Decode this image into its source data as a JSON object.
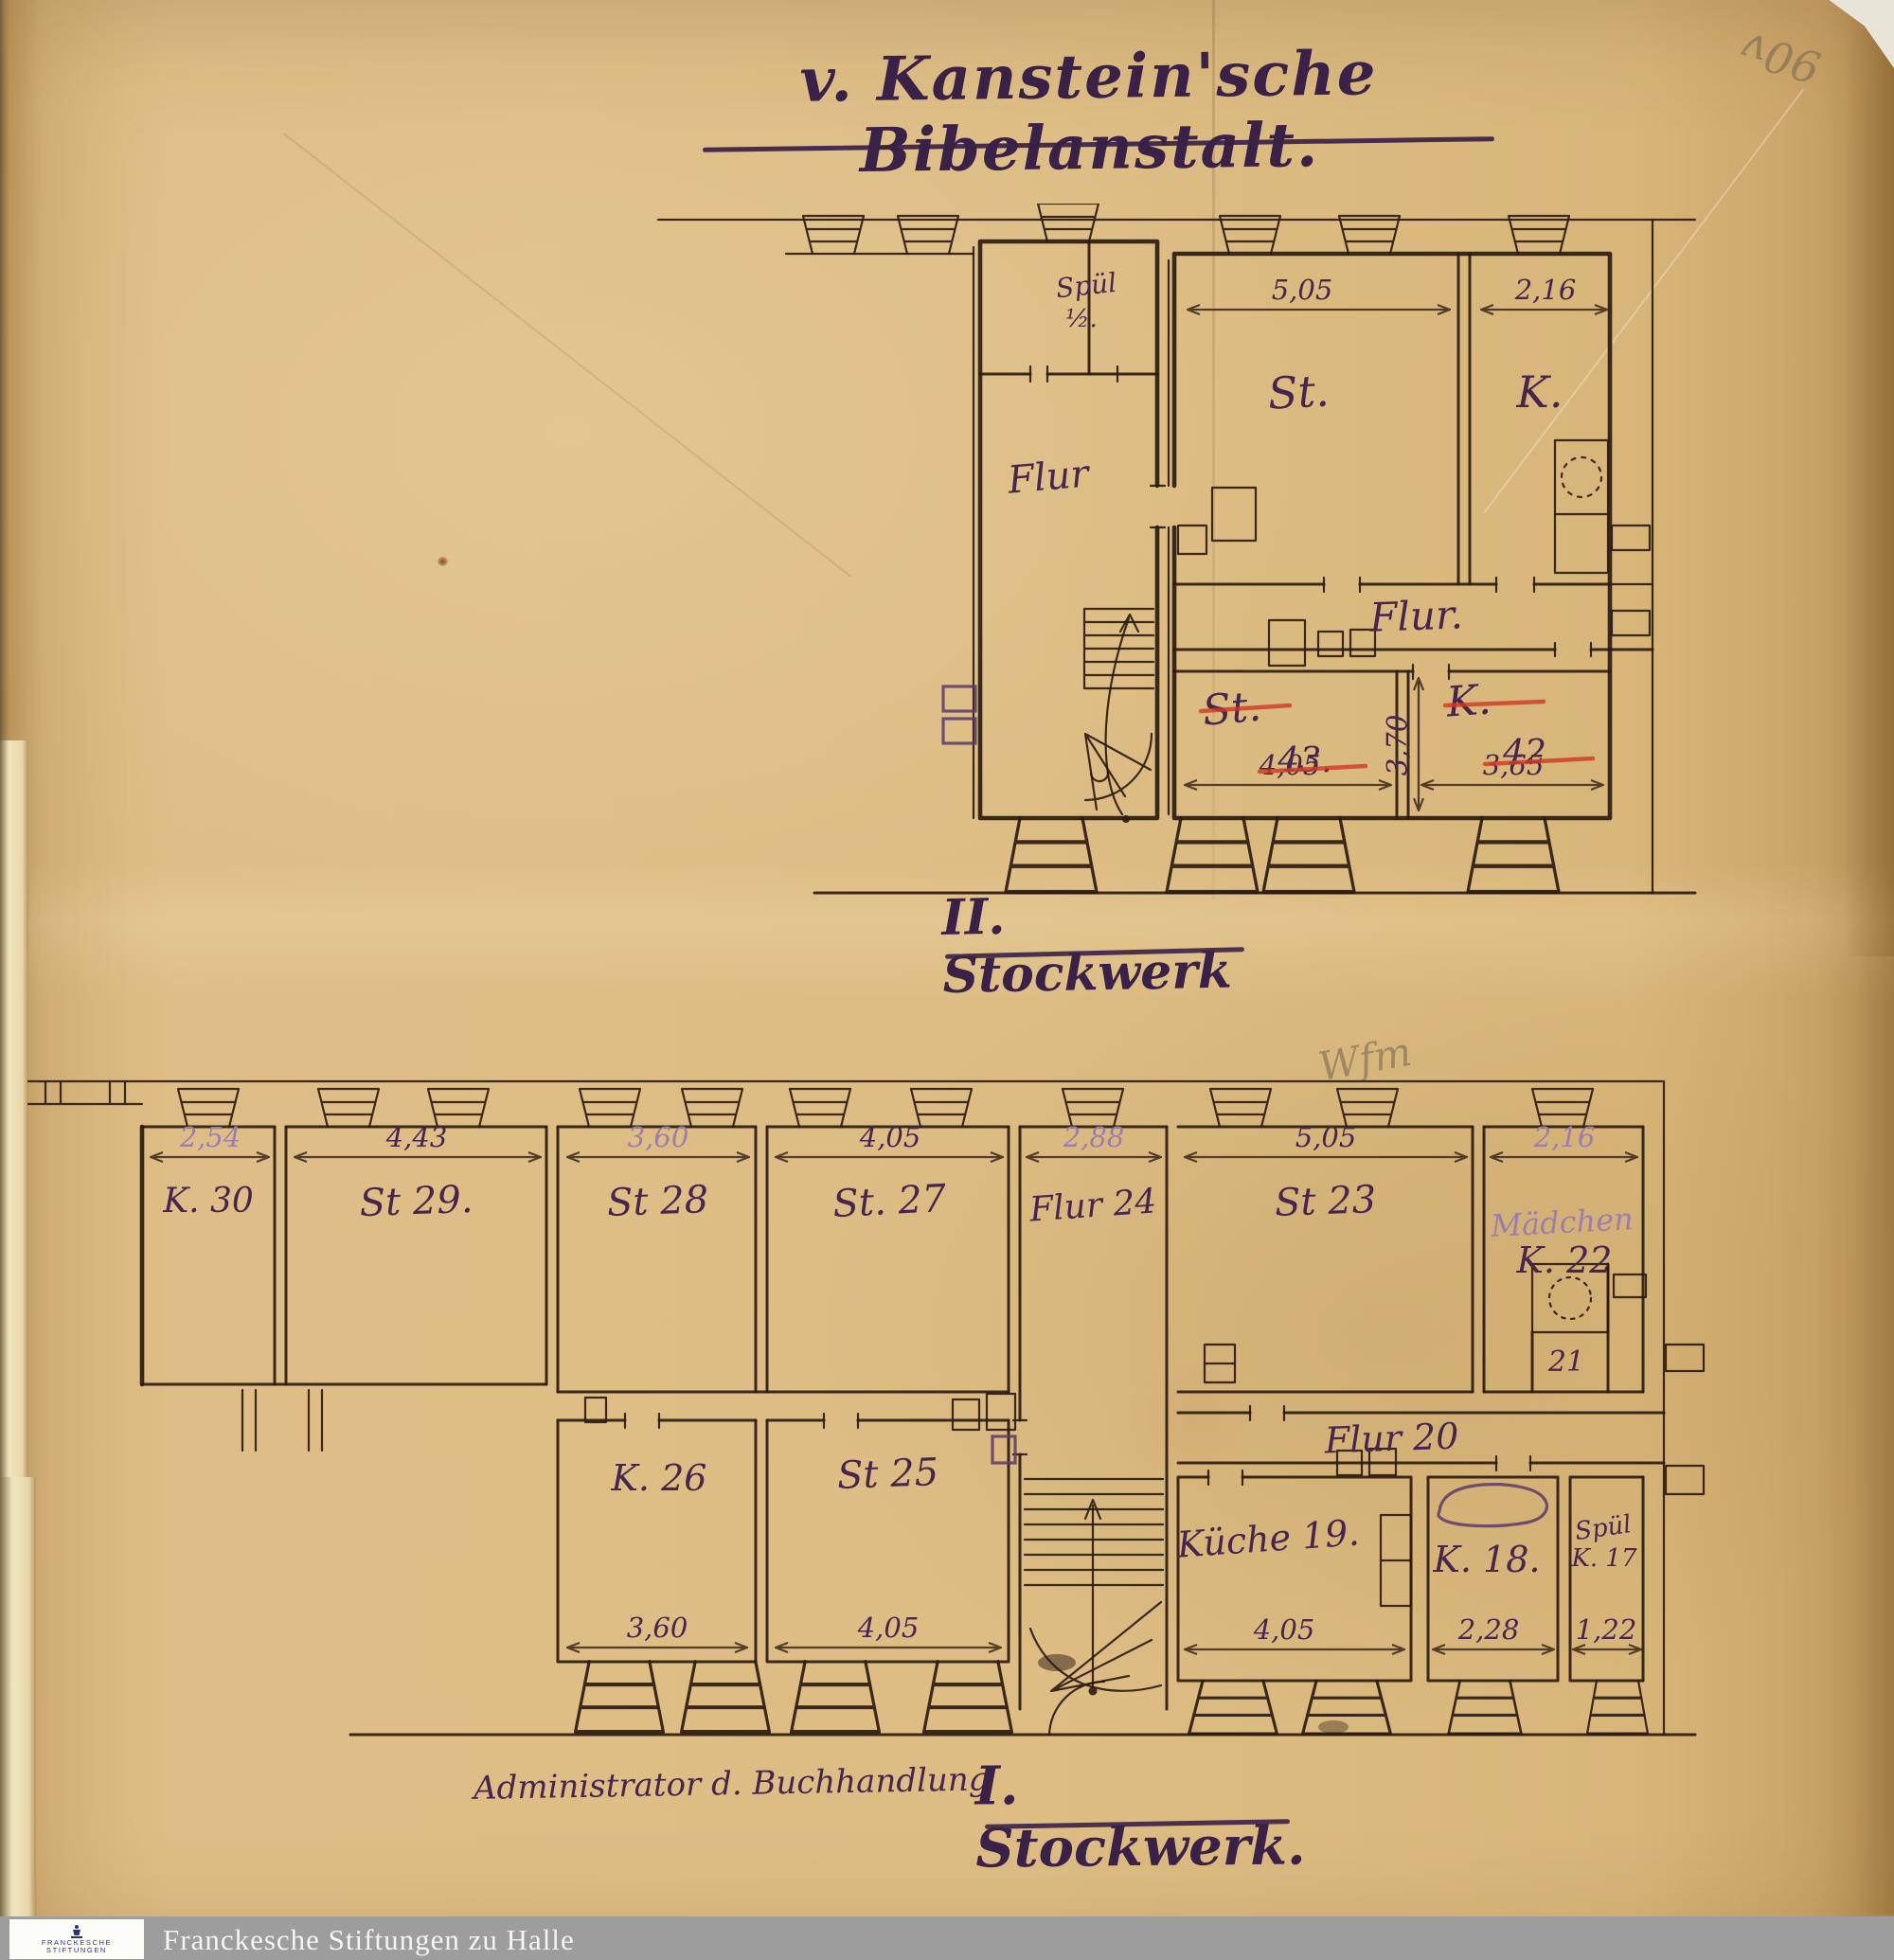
{
  "colors": {
    "paper": "#d9b87c",
    "ink": "#2b1c12",
    "handwriting": "#46264e",
    "handwriting_faded": "#9a7fae",
    "correction_red": "#d03a26",
    "pencil": "#6f6552",
    "footer_bar": "#9d9d9d",
    "logo_blue": "#26357a"
  },
  "page": {
    "title": "v. Kanstein'sche Bibelanstalt.",
    "archive_note": "90v",
    "pencil_note": "Wfm"
  },
  "upper_plan": {
    "caption": "II. Stockwerk",
    "rooms": {
      "spuel_line1": "Spül",
      "spuel_line2": "½.",
      "hall": "Flur",
      "st": "St.",
      "k": "K.",
      "corridor": "Flur.",
      "st43_label": "St.",
      "st43_number": "43.",
      "k42_label": "K.",
      "k42_number": "42"
    },
    "dims": {
      "st_width": "5,05",
      "k_width": "2,16",
      "st43_width": "4,05",
      "k42_width": "3,65",
      "k42_height": "3,70"
    }
  },
  "lower_plan": {
    "caption": "I. Stockwerk.",
    "annotation": "Administrator d. Buchhandlung",
    "rooms": {
      "k30": "K. 30",
      "st29": "St 29.",
      "st28": "St 28",
      "st27": "St. 27",
      "flur24": "Flur 24",
      "st23": "St 23",
      "maedchen": "Mädchen",
      "k22": "K. 22",
      "r21": "21",
      "flur20": "Flur 20",
      "k26": "K. 26",
      "st25": "St 25",
      "kueche19": "Küche 19.",
      "k18": "K. 18.",
      "k17_line1": "Spül",
      "k17_line2": "K. 17"
    },
    "dims": {
      "k30_width": "2,54",
      "st29_width": "4,43",
      "st28_width": "3,60",
      "st27_width": "4,05",
      "flur24_width": "2,88",
      "st23_width": "5,05",
      "k22_width": "2,16",
      "k26_width": "3,60",
      "st25_width": "4,05",
      "kueche19_width": "4,05",
      "k18_width": "2,28",
      "k17_width": "1,22"
    }
  },
  "footer": {
    "text": "Franckesche Stiftungen zu Halle",
    "logo_line1": "FRANCKESCHE",
    "logo_line2": "STIFTUNGEN"
  }
}
